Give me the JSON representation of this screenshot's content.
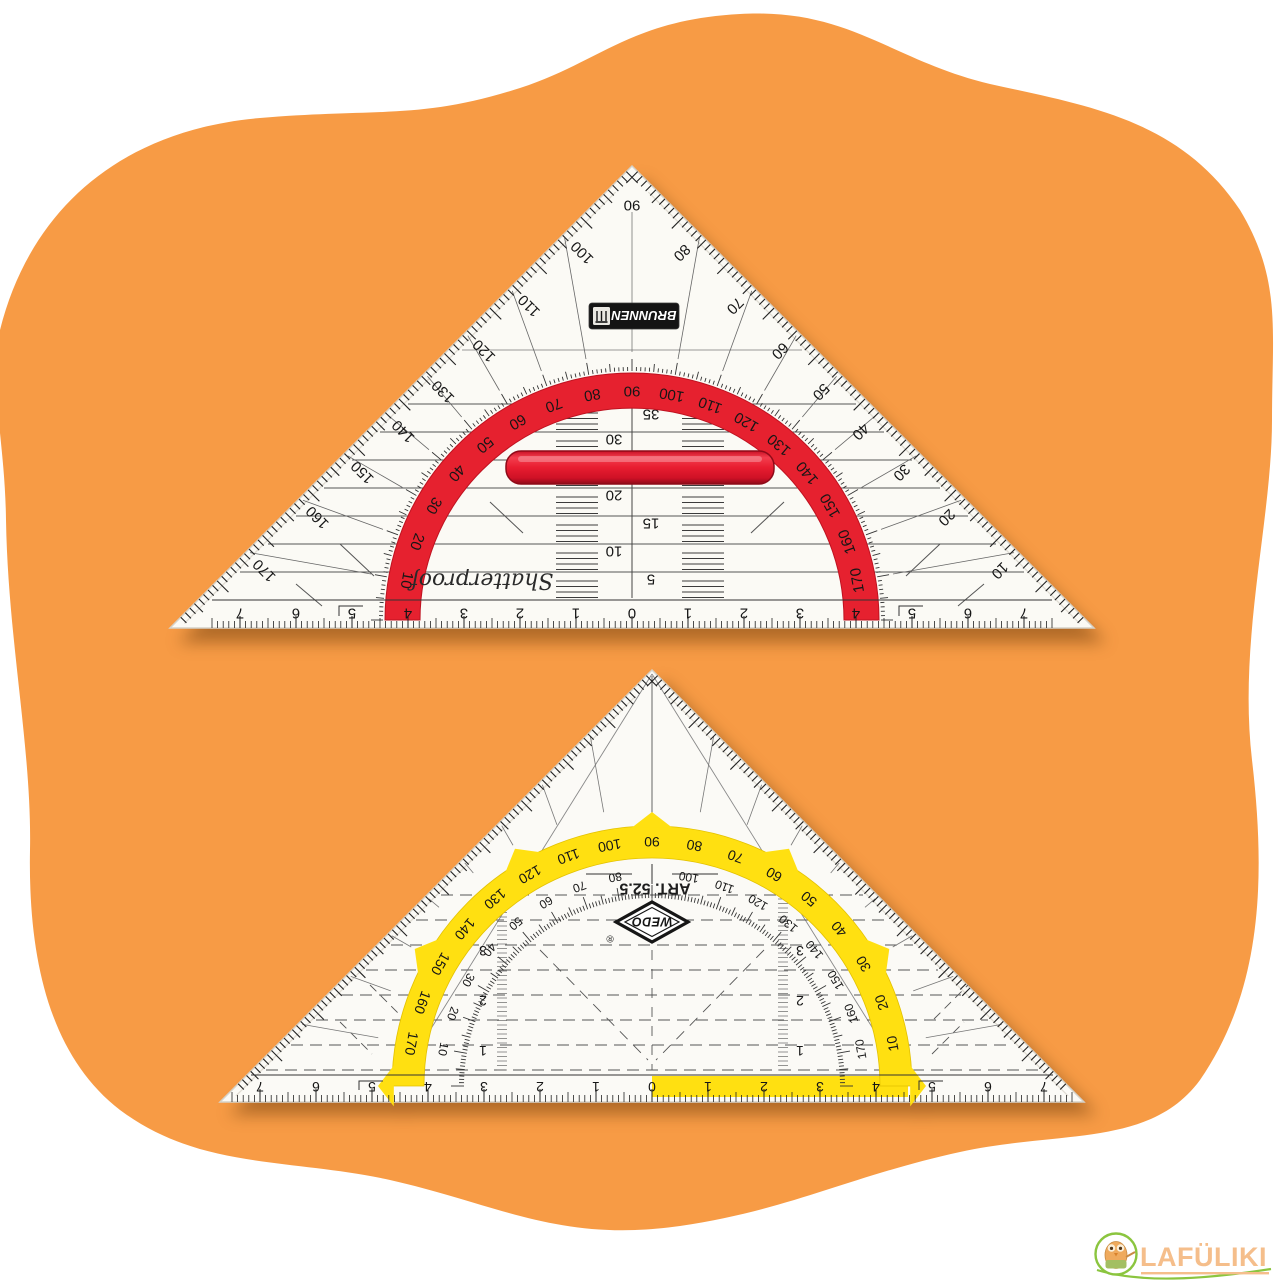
{
  "background": {
    "blob_color": "#F79B45"
  },
  "top_ruler": {
    "brand": "BRUNNEN",
    "tagline": "Shatterproof",
    "arc_color": "#E6212F",
    "apex_degree": "90",
    "left_edge_degrees": [
      "100",
      "110",
      "120",
      "130",
      "140",
      "150",
      "160",
      "170"
    ],
    "right_edge_degrees": [
      "80",
      "70",
      "60",
      "50",
      "40",
      "30",
      "20",
      "10"
    ],
    "arc_degrees": [
      "10",
      "20",
      "30",
      "40",
      "50",
      "60",
      "70",
      "80",
      "90",
      "100",
      "110",
      "120",
      "130",
      "140",
      "150",
      "160",
      "170"
    ],
    "mm_grid_labels": [
      "5",
      "10",
      "15",
      "20",
      "30",
      "35"
    ],
    "cm_scale": [
      "7",
      "6",
      "5",
      "4",
      "3",
      "2",
      "1",
      "0",
      "1",
      "2",
      "3",
      "4",
      "5",
      "6",
      "7"
    ]
  },
  "bottom_ruler": {
    "brand": "WEDO",
    "registered_mark": "®",
    "article": "ART. 52.5",
    "arc_color": "#FFE011",
    "outer_arc_degrees": [
      "170",
      "160",
      "150",
      "140",
      "130",
      "120",
      "110",
      "100",
      "90",
      "80",
      "70",
      "60",
      "50",
      "40",
      "30",
      "20",
      "10"
    ],
    "inner_arc_degrees": [
      "10",
      "20",
      "30",
      "40",
      "50",
      "60",
      "70",
      "80",
      "100",
      "110",
      "120",
      "130",
      "140",
      "150",
      "160",
      "170"
    ],
    "grid_labels": [
      "1",
      "2",
      "3"
    ],
    "cm_scale": [
      "7",
      "6",
      "5",
      "4",
      "3",
      "2",
      "1",
      "0",
      "1",
      "2",
      "3",
      "4",
      "5",
      "6",
      "7"
    ]
  },
  "watermark": {
    "text": "LAFÜLIKI",
    "text_color": "#F5BE8B",
    "accent_color": "#8BC53F"
  }
}
